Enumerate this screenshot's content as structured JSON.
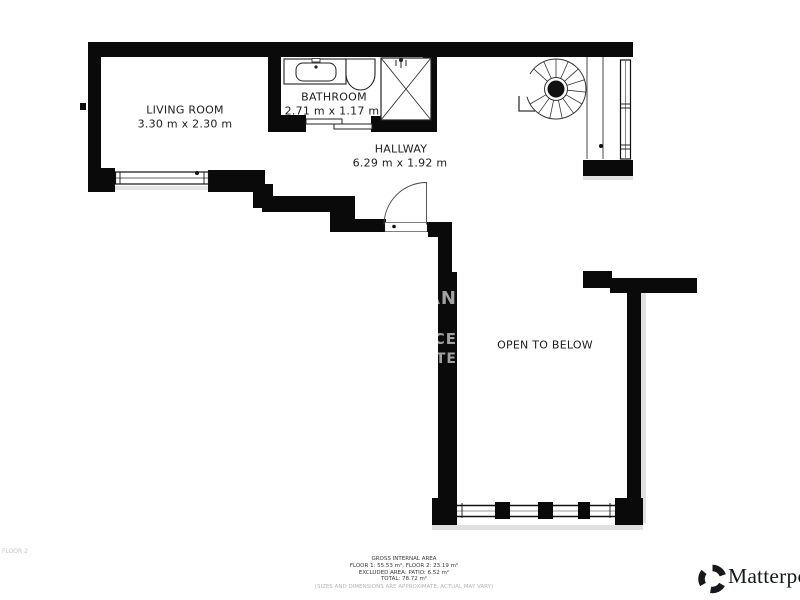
{
  "plan": {
    "rooms": [
      {
        "name": "LIVING ROOM",
        "dims": "3.30 m x 2.30 m"
      },
      {
        "name": "BATHROOM",
        "dims": "2.71 m x 1.17 m"
      },
      {
        "name": "HALLWAY",
        "dims": "6.29 m x 1.92 m"
      },
      {
        "name": "OPEN TO BELOW",
        "dims": ""
      }
    ],
    "floor_label": "FLOOR 2",
    "watermark_fragments": [
      "AN",
      "CE",
      "TE"
    ]
  },
  "footer": {
    "title": "GROSS INTERNAL AREA",
    "floors": "FLOOR 1: 55.53 m², FLOOR 2: 23.19 m²",
    "excluded": "EXCLUDED AREA: PATIO: 6.52 m²",
    "total": "TOTAL: 78.72 m²",
    "disclaimer": "(SIZES AND DIMENSIONS ARE APPROXIMATE, ACTUAL MAY VARY)"
  },
  "brand": {
    "name": "Matterport"
  },
  "colors": {
    "wall": "#0a0a0a",
    "label_text": "#1d1d1d",
    "muted": "#b5b5b5"
  }
}
